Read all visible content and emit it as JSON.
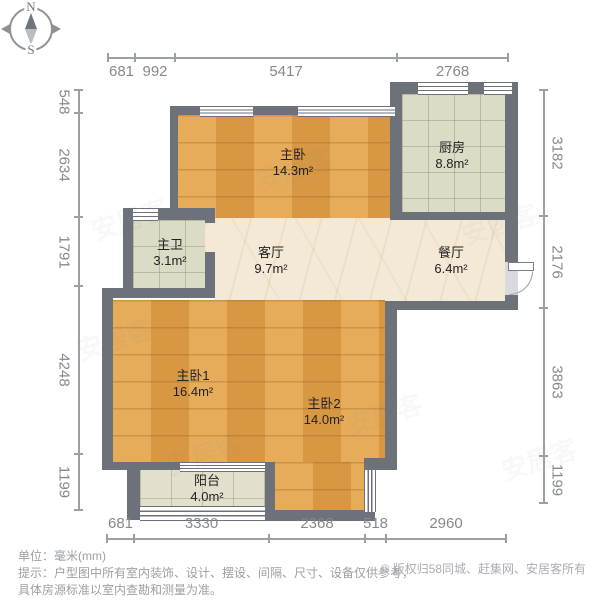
{
  "compass": {
    "north_label": "N",
    "south_label": "S"
  },
  "watermark": "安居客",
  "rooms": {
    "master_bedroom_top": {
      "name": "主卧",
      "area": "14.3m²"
    },
    "kitchen": {
      "name": "厨房",
      "area": "8.8m²"
    },
    "master_bath": {
      "name": "主卫",
      "area": "3.1m²"
    },
    "living_room": {
      "name": "客厅",
      "area": "9.7m²"
    },
    "dining_room": {
      "name": "餐厅",
      "area": "6.4m²"
    },
    "master_bedroom_1": {
      "name": "主卧1",
      "area": "16.4m²"
    },
    "master_bedroom_2": {
      "name": "主卧2",
      "area": "14.0m²"
    },
    "balcony": {
      "name": "阳台",
      "area": "4.0m²"
    }
  },
  "dimensions": {
    "top": [
      "681",
      "992",
      "5417",
      "2768"
    ],
    "bottom": [
      "681",
      "3330",
      "2368",
      "518",
      "2960"
    ],
    "left": [
      "548",
      "2634",
      "1791",
      "4248",
      "1199"
    ],
    "right": [
      "3182",
      "2176",
      "3863",
      "1199"
    ]
  },
  "notes": {
    "unit": "单位：毫米(mm)",
    "disclaimer_line1": "提示：户型图中所有室内装饰、设计、摆设、间隔、尺寸、设备仅供参考，",
    "disclaimer_line2": "具体房源标准以室内查勘和测量为准。"
  },
  "copyright": "© 版权归58同城、赶集网、安居客所有",
  "colors": {
    "wall": "#6d727a",
    "wood_floor": "#dfa049",
    "tile_floor": "#dbdcc6",
    "marble_floor": "#f3e9d6",
    "dimension_text": "#85898f"
  }
}
